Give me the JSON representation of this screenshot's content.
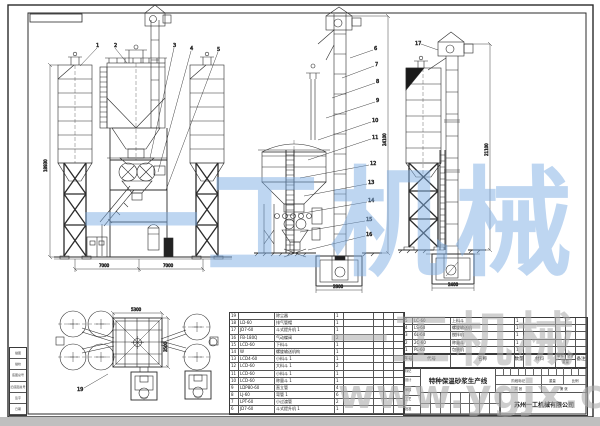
{
  "watermarks": {
    "brand_center": "一工机械",
    "brand_corner": "一工机械",
    "url": "www.ygjx.cn",
    "blue": "#7daee4",
    "gray": "#a9a9a9"
  },
  "title_block": {
    "title": "特种保温砂浆生产线",
    "company": "苏州一工机械有限公司",
    "stage_labels": [
      "阶段标记",
      "重量",
      "比例"
    ],
    "sheet_left": "共 张",
    "sheet_right": "第 张",
    "left_labels": [
      "标记",
      "设计",
      "审核",
      "工艺",
      "批准"
    ],
    "binding_labels": [
      "描图",
      "描校",
      "底图总号",
      "旧底图总号",
      "签字",
      "日期"
    ]
  },
  "bom_header": {
    "no": "序号",
    "code": "代号",
    "name": "名称",
    "qty": "数量",
    "material": "材料",
    "weight": "重量",
    "weight_unit": "单件",
    "weight_total": "总计",
    "remark": "备注"
  },
  "bom_left": {
    "rows": [
      [
        "19",
        "",
        "除尘器",
        "1"
      ],
      [
        "18",
        "LD-60",
        "排气管帽",
        "1"
      ],
      [
        "17",
        "JD7-60",
        "斗式提升机 1",
        "1"
      ],
      [
        "16",
        "FB-180Q",
        "气动蝶阀",
        "2"
      ],
      [
        "15",
        "LCD-60",
        "下料斗",
        "1"
      ],
      [
        "14",
        "W",
        "螺旋输送机构",
        "1"
      ],
      [
        "13",
        "LCD4-60",
        "小料斗 1",
        "1"
      ],
      [
        "12",
        "LCD-60",
        "大料斗 1",
        "2"
      ],
      [
        "11",
        "LCD-60",
        "小料斗 1",
        "1"
      ],
      [
        "10",
        "LCD-60",
        "称量斗 1",
        "1"
      ],
      [
        "9",
        "LDP80-60",
        "直立管",
        "4"
      ],
      [
        "8",
        "LJ-60",
        "弯管 1",
        "6"
      ],
      [
        "7",
        "LPT-60",
        "小过渡管",
        "2"
      ],
      [
        "6",
        "JD7-60",
        "斗式提升机 1",
        "1"
      ]
    ]
  },
  "bom_right": {
    "rows": [
      [
        "5",
        "LC-60",
        "上料斗",
        "1"
      ],
      [
        "4",
        "LS-60",
        "螺旋输送机",
        "1"
      ],
      [
        "3",
        "6L-60",
        "搅拌机",
        "1"
      ],
      [
        "2",
        "2C-60",
        "称量斗",
        "1"
      ],
      [
        "1",
        "PL-60",
        "包装机",
        "1"
      ]
    ]
  },
  "callouts": {
    "front": [
      "1",
      "2",
      "3",
      "4",
      "5"
    ],
    "side": [
      "6",
      "7",
      "8",
      "9",
      "10",
      "11",
      "12",
      "13",
      "14",
      "15",
      "16"
    ],
    "right": [
      "17"
    ],
    "plan": [
      "19"
    ]
  },
  "dimensions": {
    "front_height": "18930",
    "front_bay_left": "7000",
    "front_bay_right": "7000",
    "side_height": "24100",
    "side_pit": "2800",
    "right_height": "21100",
    "right_pit": "2400",
    "plan_width": "5300",
    "plan_depth": "3500"
  }
}
